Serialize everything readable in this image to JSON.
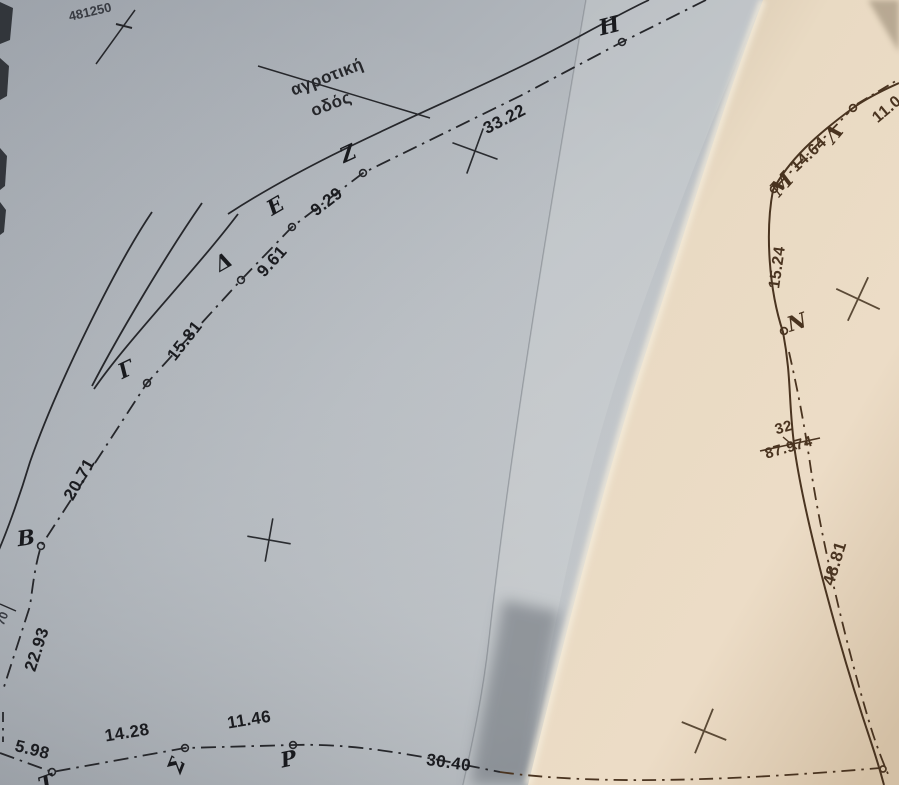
{
  "meta": {
    "description": "Photograph of a folded paper topographic / cadastral survey plan with Greek point labels and distances",
    "ink_color_left_sheet": "#26272b",
    "ink_color_right_sheet": "#4a3420",
    "paper_color_left": "#b3b8be",
    "paper_color_right": "#e7d8c2"
  },
  "survey": {
    "road_label": {
      "line1": "αγροτική",
      "line2": "οδός"
    },
    "grid_coordinate": "481250",
    "edge_coordinate_fragment": "70",
    "left_parcel_points": [
      "Η",
      "Ζ",
      "Ε",
      "Δ",
      "Γ",
      "Β",
      "Σ",
      "Ρ",
      "Τ"
    ],
    "right_parcel_points": [
      "Λ",
      "Μ",
      "Ν"
    ],
    "segments": [
      {
        "between": "Η–Ζ",
        "distance": "33.22"
      },
      {
        "between": "Ζ–Ε",
        "distance": "9.29"
      },
      {
        "between": "Ε–Δ",
        "distance": "9.61"
      },
      {
        "between": "Δ–Γ",
        "distance": "15.81"
      },
      {
        "between": "Γ–Β",
        "distance": "20.71"
      },
      {
        "between": "Β–edge",
        "distance": "22.93"
      },
      {
        "between": "edge–Τ",
        "distance": "5.98"
      },
      {
        "between": "Τ–Σ",
        "distance": "14.28"
      },
      {
        "between": "Σ–Ρ",
        "distance": "11.46"
      },
      {
        "between": "Ρ–edge",
        "distance": "30.40"
      },
      {
        "between": "Λ–edge",
        "distance": "11.0"
      },
      {
        "between": "Λ–Μ",
        "distance": "14.64"
      },
      {
        "between": "Μ–Ν",
        "distance": "15.24"
      },
      {
        "between": "Ν–edge",
        "distance": "48.81"
      }
    ],
    "spot_marker": {
      "number": "32",
      "value": "87.974"
    }
  },
  "labels": [
    {
      "id": "point-h",
      "text": "Η",
      "x": 611,
      "y": 33,
      "rot": -14,
      "size": 22,
      "cls": "pt"
    },
    {
      "id": "point-z",
      "text": "Ζ",
      "x": 351,
      "y": 160,
      "rot": -25,
      "size": 21,
      "cls": "pt"
    },
    {
      "id": "point-e",
      "text": "Ε",
      "x": 279,
      "y": 212,
      "rot": -30,
      "size": 21,
      "cls": "pt"
    },
    {
      "id": "point-d",
      "text": "Δ",
      "x": 227,
      "y": 268,
      "rot": -30,
      "size": 21,
      "cls": "pt"
    },
    {
      "id": "point-g",
      "text": "Γ",
      "x": 129,
      "y": 376,
      "rot": -25,
      "size": 21,
      "cls": "pt"
    },
    {
      "id": "point-b",
      "text": "Β",
      "x": 27,
      "y": 545,
      "rot": -8,
      "size": 21,
      "cls": "pt"
    },
    {
      "id": "point-s",
      "text": "Σ",
      "x": 183,
      "y": 768,
      "rot": -68,
      "size": 21,
      "cls": "pt"
    },
    {
      "id": "point-r",
      "text": "Ρ",
      "x": 290,
      "y": 766,
      "rot": -12,
      "size": 21,
      "cls": "pt"
    },
    {
      "id": "point-t",
      "text": "Τ",
      "x": 49,
      "y": 790,
      "rot": -20,
      "size": 21,
      "cls": "pt"
    },
    {
      "id": "point-l",
      "text": "Λ",
      "x": 839,
      "y": 138,
      "rot": -50,
      "size": 21,
      "cls": "pt-r"
    },
    {
      "id": "point-m",
      "text": "Μ",
      "x": 787,
      "y": 189,
      "rot": -48,
      "size": 21,
      "cls": "pt-r"
    },
    {
      "id": "point-n",
      "text": "Ν",
      "x": 799,
      "y": 329,
      "rot": -18,
      "size": 21,
      "cls": "pt-r"
    },
    {
      "id": "dist-33-22",
      "text": "33.22",
      "x": 507,
      "y": 124,
      "rot": -27,
      "size": 17,
      "cls": "num"
    },
    {
      "id": "dist-9-29",
      "text": "9.29",
      "x": 330,
      "y": 206,
      "rot": -38,
      "size": 17,
      "cls": "num"
    },
    {
      "id": "dist-9-61",
      "text": "9.61",
      "x": 276,
      "y": 265,
      "rot": -48,
      "size": 17,
      "cls": "num"
    },
    {
      "id": "dist-15-81",
      "text": "15.81",
      "x": 189,
      "y": 344,
      "rot": -52,
      "size": 17,
      "cls": "num"
    },
    {
      "id": "dist-20-71",
      "text": "20.71",
      "x": 84,
      "y": 482,
      "rot": -60,
      "size": 17,
      "cls": "num"
    },
    {
      "id": "dist-22-93",
      "text": "22.93",
      "x": 42,
      "y": 651,
      "rot": -72,
      "size": 17,
      "cls": "num"
    },
    {
      "id": "dist-5-98",
      "text": "5.98",
      "x": 31,
      "y": 755,
      "rot": 14,
      "size": 17,
      "cls": "num"
    },
    {
      "id": "dist-14-28",
      "text": "14.28",
      "x": 128,
      "y": 738,
      "rot": -9,
      "size": 17,
      "cls": "num"
    },
    {
      "id": "dist-11-46",
      "text": "11.46",
      "x": 250,
      "y": 725,
      "rot": -9,
      "size": 17,
      "cls": "num"
    },
    {
      "id": "dist-30-40",
      "text": "30.40",
      "x": 448,
      "y": 768,
      "rot": 8,
      "size": 17,
      "cls": "num"
    },
    {
      "id": "dist-14-64",
      "text": "14.64",
      "x": 812,
      "y": 158,
      "rot": -43,
      "size": 16,
      "cls": "num-r"
    },
    {
      "id": "dist-11-0",
      "text": "11.0",
      "x": 890,
      "y": 113,
      "rot": -40,
      "size": 16,
      "cls": "num-r"
    },
    {
      "id": "dist-15-24",
      "text": "15.24",
      "x": 782,
      "y": 268,
      "rot": -82,
      "size": 16,
      "cls": "num-r"
    },
    {
      "id": "dist-48-81",
      "text": "48.81",
      "x": 840,
      "y": 565,
      "rot": -73,
      "size": 17,
      "cls": "num-r"
    },
    {
      "id": "spot-number",
      "text": "32",
      "x": 785,
      "y": 432,
      "rot": -16,
      "size": 15,
      "cls": "num-r"
    },
    {
      "id": "spot-value",
      "text": "87.974",
      "x": 790,
      "y": 452,
      "rot": -16,
      "size": 15,
      "cls": "num-r"
    },
    {
      "id": "grid-coordinate",
      "text": "481250",
      "x": 91,
      "y": 16,
      "rot": -13,
      "size": 13,
      "cls": "coord"
    },
    {
      "id": "edge-fragment",
      "text": "70",
      "x": 6,
      "y": 620,
      "rot": -68,
      "size": 12,
      "cls": "coord"
    },
    {
      "id": "road-label-1",
      "text": "αγροτική",
      "x": 329,
      "y": 82,
      "rot": -21,
      "size": 17,
      "cls": "road"
    },
    {
      "id": "road-label-2",
      "text": "οδός",
      "x": 333,
      "y": 109,
      "rot": -21,
      "size": 17,
      "cls": "road"
    }
  ]
}
